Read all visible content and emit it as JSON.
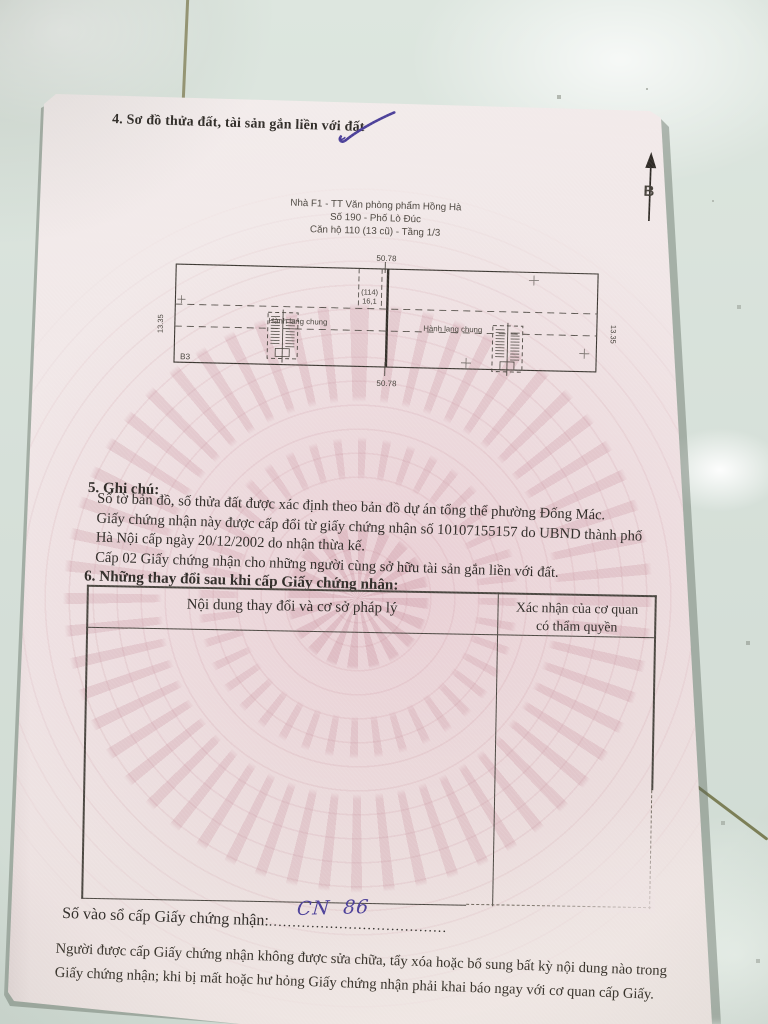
{
  "ink_color": "#4a3e98",
  "section4": {
    "title": "4. Sơ đồ thửa đất, tài sản gắn liền với đất"
  },
  "plan": {
    "caption_lines": [
      "Nhà F1 - TT Văn phòng phẩm Hồng Hà",
      "Số 190 - Phố Lò Đúc",
      "Căn hộ 110 (13 cũ) - Tầng 1/3"
    ],
    "north_label": "B",
    "dims": {
      "top": "50.78",
      "bottom": "50.78",
      "left": "13.35",
      "right": "13.35"
    },
    "room": {
      "number": "(114)",
      "area": "16,1"
    },
    "corridor_left_label": "Hành lang chung",
    "corridor_right_label": "Hành lang chung",
    "block_label": "B3"
  },
  "section5": {
    "title": "5. Ghi chú:",
    "notes": [
      "Số tờ bản đồ, số thửa đất được xác định theo bản đồ dự án tổng thể phường Đống Mác.",
      "Giấy chứng nhận này được cấp đổi từ giấy chứng nhận số 10107155157 do UBND thành phố",
      "Hà Nội cấp ngày 20/12/2002 do nhận thừa kế.",
      "Cấp 02 Giấy chứng nhận cho những người cùng sở hữu tài sản gắn liền với đất."
    ]
  },
  "section6": {
    "title": "6. Những thay đổi sau khi cấp Giấy chứng nhận:"
  },
  "changes_table": {
    "column1_header": "Nội dung thay đổi và cơ sở pháp lý",
    "column2_header_line1": "Xác nhận của cơ quan",
    "column2_header_line2": "có thẩm quyền"
  },
  "registry": {
    "label": "Số vào sổ cấp Giấy chứng nhận:",
    "dots": "......................................",
    "handwritten_number": "CN 86"
  },
  "footer": {
    "line1": "Người được cấp Giấy chứng nhận không được sửa chữa, tẩy xóa hoặc bổ sung bất kỳ nội dung nào trong",
    "line2": "Giấy chứng nhận; khi bị mất hoặc hư hỏng Giấy chứng nhận phải khai báo ngay với cơ quan cấp Giấy."
  }
}
